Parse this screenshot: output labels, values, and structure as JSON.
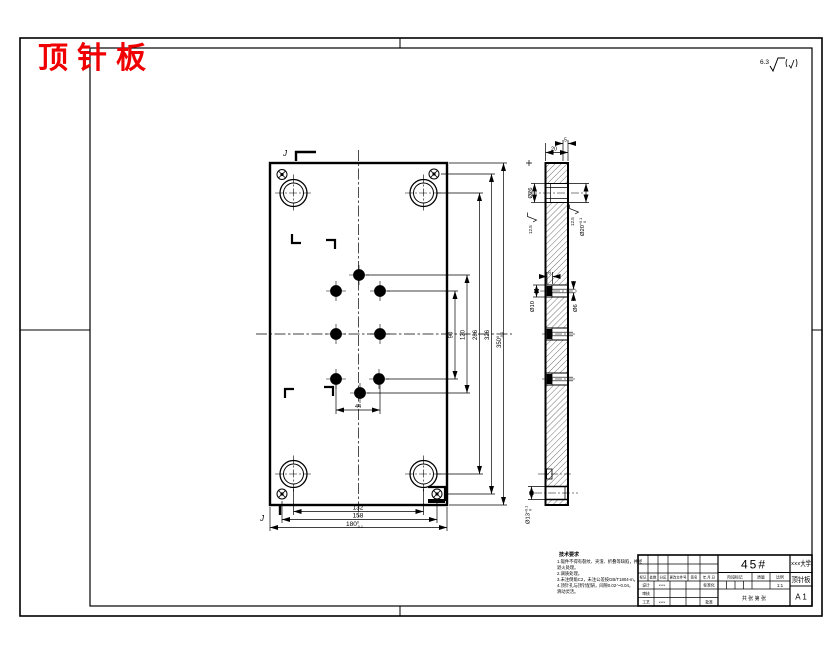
{
  "title": "顶针板",
  "corner_roughness": {
    "value": "6.3"
  },
  "front_view": {
    "section_label_top": "J",
    "section_label_bottom": "J",
    "dim_pin_spacing": "44",
    "dims_bottom": [
      {
        "main": "132"
      },
      {
        "main": "158"
      },
      {
        "main": "180",
        "sup": "0",
        "sub": "-0.1"
      }
    ],
    "dims_right": [
      {
        "main": "90"
      },
      {
        "main": "120"
      },
      {
        "main": "286"
      },
      {
        "main": "326"
      },
      {
        "main": "350",
        "sup": "0",
        "sub": "-0.1"
      }
    ]
  },
  "side_view": {
    "dim_step": "5",
    "dim_thickness": "20",
    "dim_bore_left": "Ø26",
    "dim_bore_right": {
      "main": "Ø20",
      "sup": "+0.1",
      "sub": "0"
    },
    "roughness_bore_right": "12.5",
    "roughness_bore_left": "12.5",
    "dim_pin_depth": "6",
    "dim_pin_cbore": "Ø10",
    "dim_pin_hole": "Ø6",
    "dim_bottom_bore": {
      "main": "Ø13",
      "sup": "+0.1",
      "sub": "0"
    }
  },
  "notes": {
    "title": "技术要求",
    "lines": [
      "1.锻件不得有裂纹、夹渣、折叠等缺陷，并经",
      "  退火处理。",
      "2.调质处理。",
      "3.未注倒角C2，未注公差按GB/T1804-m。",
      "4.顶针孔与顶针配研，间隙0.02～0.04，",
      "  滑动灵活。"
    ]
  },
  "title_block": {
    "material": "45#",
    "org": "×××大学",
    "part": "顶针板",
    "size": "A 1",
    "scale_value": "1:1",
    "header_cells": [
      "标记",
      "处数",
      "分区",
      "更改文件号",
      "签名",
      "年.月.日"
    ],
    "row_design_label": "设计",
    "row_design_sig": "×××",
    "row_std_label": "标准化",
    "row_check_label": "审核",
    "row_process_label": "工艺",
    "row_process_sig": "×××",
    "row_approve_label": "批准",
    "stage_label": "阶段标记",
    "mass_label": "质量",
    "scale_label": "比例",
    "sheet_text": "共 张 第 张"
  }
}
